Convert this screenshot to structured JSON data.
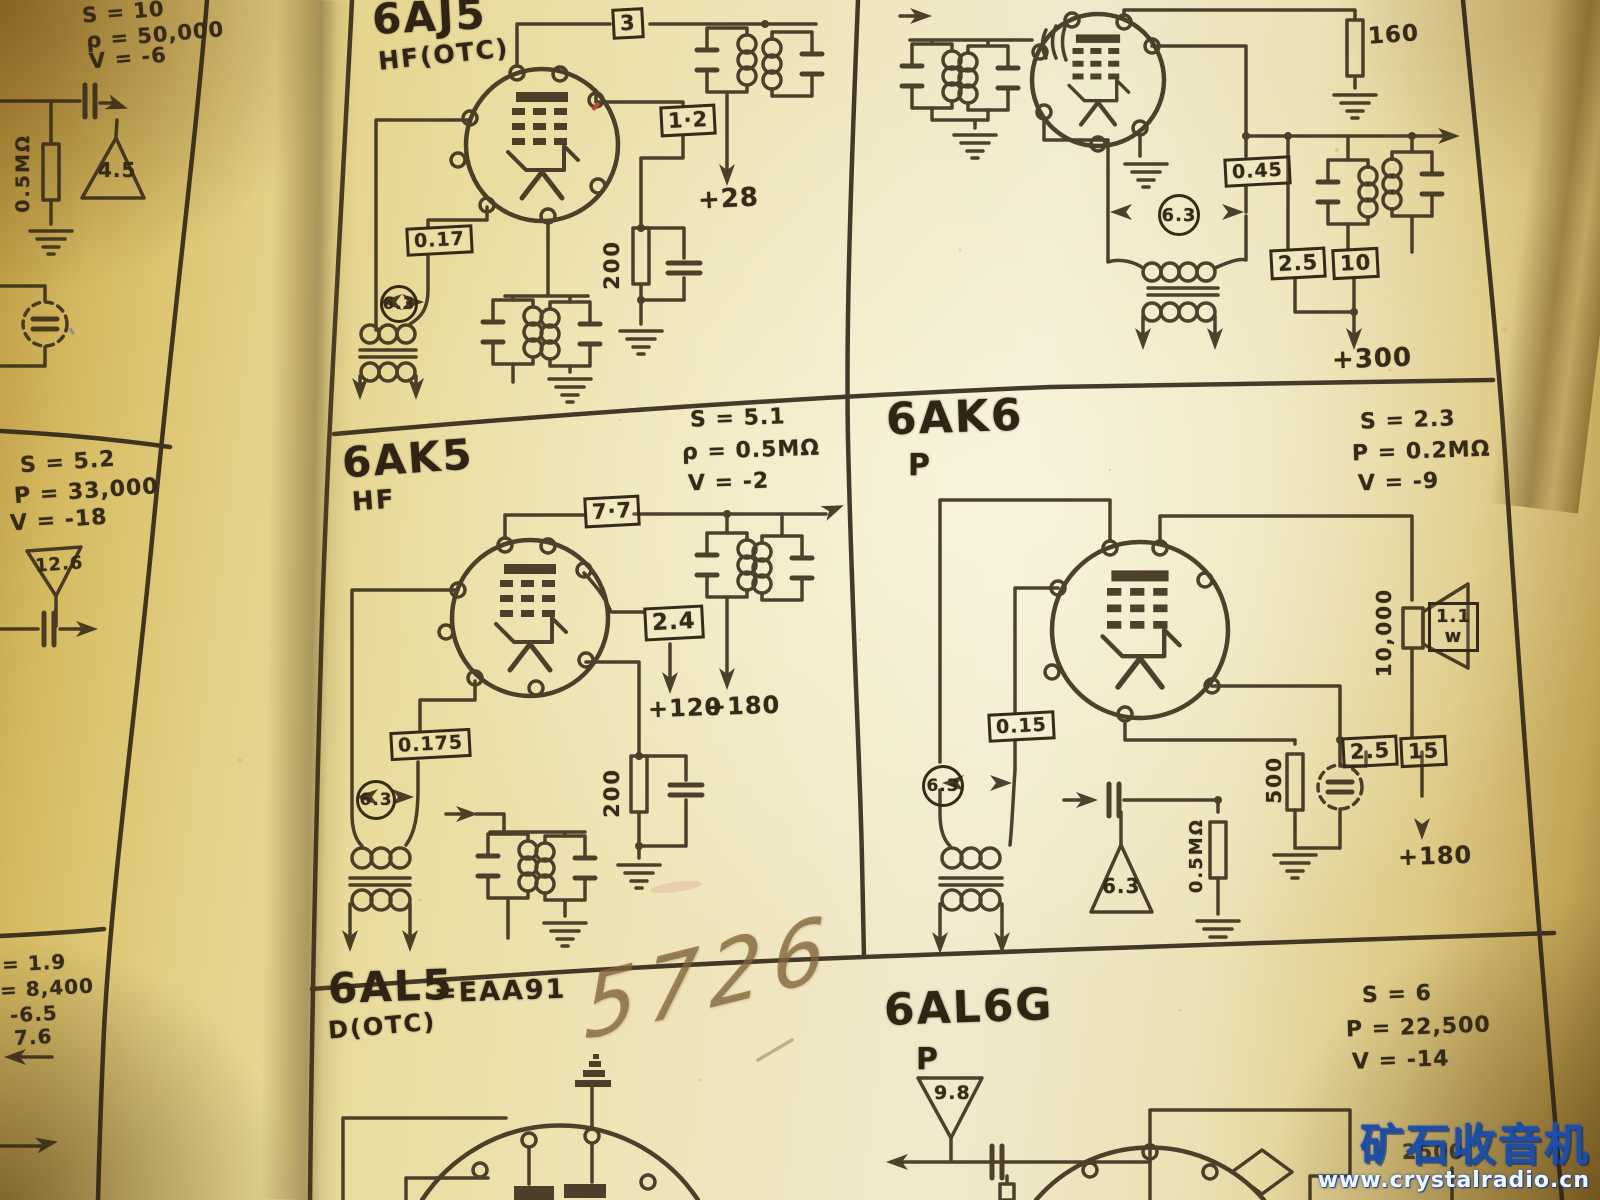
{
  "watermark": {
    "title": "矿石收音机",
    "url": "www.crystalradio.cn"
  },
  "left_page": {
    "top_cell": {
      "param_s": "S = 10",
      "param_p": "ρ = 50,000",
      "param_v": "V = -6",
      "resistor": "0.5MΩ",
      "triangle": "4.5"
    },
    "mid_cell": {
      "param_s": "S = 5.2",
      "param_p": "P = 33,000",
      "param_v": "V = -18",
      "triangle": "12.6"
    },
    "bottom_cell": {
      "line1": "= 1.9",
      "line2": "= 8,400",
      "line3": "-6.5",
      "line4": "7.6"
    }
  },
  "cells": {
    "aj5": {
      "title": "6AJ5",
      "subtitle": "HF(OTC)",
      "box_top": "3",
      "box_mid": "1·2",
      "supply": "+28",
      "box_left": "0.17",
      "heater": "6.3",
      "resistor": "200"
    },
    "top_right": {
      "resistor_top": "160",
      "box_c": "0.45",
      "heater": "6.3",
      "box_a": "2.5",
      "box_b": "10",
      "supply": "+300"
    },
    "ak5": {
      "title": "6AK5",
      "subtitle": "HF",
      "param_s": "S = 5.1",
      "param_p": "ρ = 0.5MΩ",
      "param_v": "V = -2",
      "box_top": "7·7",
      "box_mid": "2.4",
      "supply1": "+120",
      "supply2": "+180",
      "box_left": "0.175",
      "heater": "6.3",
      "resistor": "200"
    },
    "ak6": {
      "title": "6AK6",
      "subtitle": "P",
      "param_s": "S = 2.3",
      "param_p": "P = 0.2MΩ",
      "param_v": "V = -9",
      "box_left": "0.15",
      "heater": "6.3",
      "trans_label": "10,000",
      "spk_val": "1.1",
      "spk_unit": "w",
      "box_a": "2.5",
      "box_b": "15",
      "res_a": "500",
      "res_b": "0.5MΩ",
      "triangle": "6.3",
      "supply": "+180"
    },
    "al5": {
      "title": "6AL5",
      "equiv": "=EAA91",
      "subtitle": "D(OTC)",
      "handwriting": "5726"
    },
    "al6g": {
      "title": "6AL6G",
      "subtitle": "P",
      "param_s": "S = 6",
      "param_p": "P = 22,500",
      "param_v": "V = -14",
      "triangle": "9.8",
      "partial_value": "2500"
    }
  }
}
